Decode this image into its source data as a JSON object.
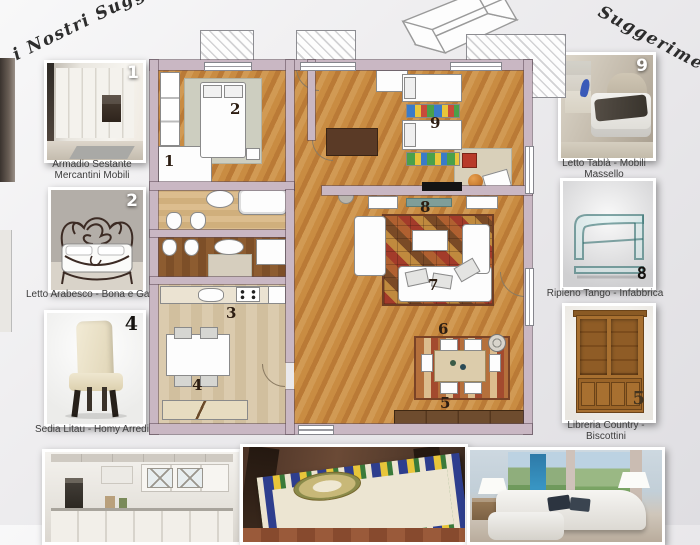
{
  "title": {
    "left_fragment": "i Nostri Sugge",
    "right_fragment": "Suggerimenti!"
  },
  "palette": {
    "wall": "#c9b7c3",
    "wood_floor": "#c48a42",
    "kitchen_floor": "#d6c5a8",
    "bathroom_dark_floor": "#855428",
    "background": "#eeedef",
    "caption_text": "#3c3c3c",
    "plan_number_color": "#2c1d12"
  },
  "floorplan": {
    "numbers": {
      "n1": "1",
      "n2": "2",
      "n3": "3",
      "n4": "4",
      "n5": "5",
      "n6": "6",
      "n7": "7",
      "n8": "8",
      "n9": "9"
    }
  },
  "left_cards": [
    {
      "number": "1",
      "caption_line1": "Armadio Sestante",
      "caption_line2": "Mercantini Mobili",
      "image": "white-corner-wardrobe-photo"
    },
    {
      "number": "2",
      "caption_line1": "Letto Arabesco - Bona e Gava",
      "caption_line2": "",
      "image": "wrought-iron-bed-photo"
    },
    {
      "number": "4",
      "caption_line1": "Sedia Litau - Homy Arredi",
      "caption_line2": "",
      "image": "cream-dining-chair-photo"
    }
  ],
  "right_cards": [
    {
      "number": "9",
      "caption_line1": "Letto Tablà - Mobili Massello",
      "caption_line2": "",
      "image": "white-wood-bed-photo"
    },
    {
      "number": "8",
      "caption_line1": "Ripieno Tango - Infabbrica",
      "caption_line2": "",
      "image": "curved-glass-table-photo"
    },
    {
      "number": "5",
      "caption_line1": "Libreria Country - Biscottini",
      "caption_line2": "",
      "image": "country-bookcase-photo"
    }
  ],
  "bottom_images": [
    {
      "image": "white-classic-kitchen-photo"
    },
    {
      "image": "majolica-top-table-photo"
    },
    {
      "image": "white-corner-sofa-photo"
    }
  ]
}
